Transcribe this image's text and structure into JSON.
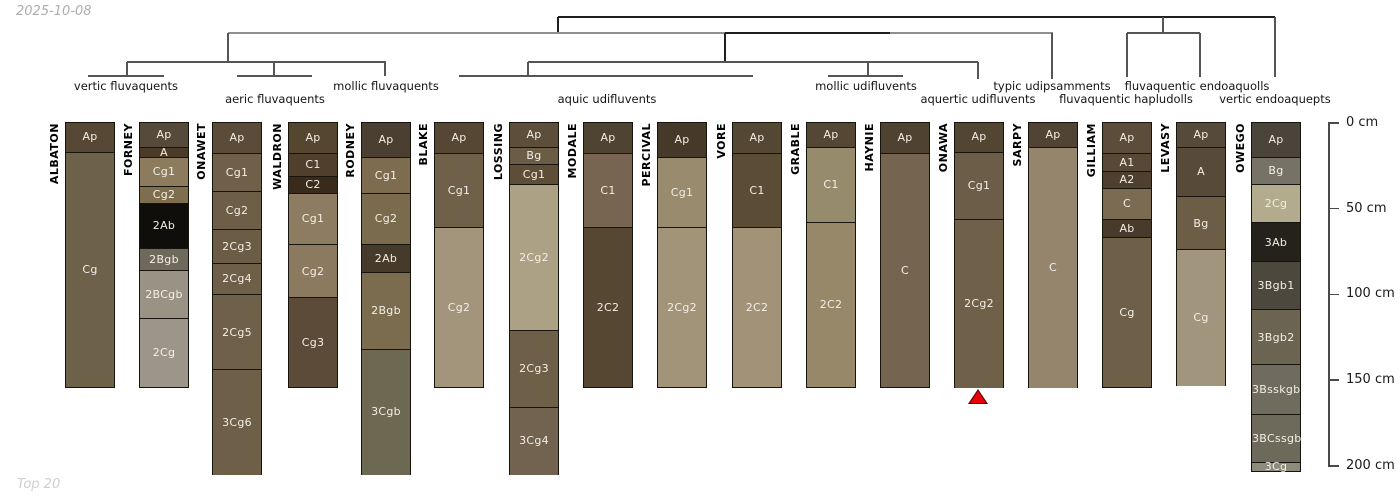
{
  "header": {
    "date": "2025-10-08"
  },
  "footer": {
    "note": "Top 20"
  },
  "depth_axis": {
    "unit": "cm",
    "ticks": [
      {
        "value": 0,
        "label": "0 cm"
      },
      {
        "value": 50,
        "label": "50 cm"
      },
      {
        "value": 100,
        "label": "100 cm"
      },
      {
        "value": 150,
        "label": "150 cm"
      },
      {
        "value": 200,
        "label": "200 cm"
      }
    ]
  },
  "chart_data": {
    "type": "dendrogram_soil_profiles",
    "description": "Hierarchical clustering dendrogram over 17 soil series profiles grouped by taxonomic subgroup, with horizon columns drawn to a 0-200 cm depth scale",
    "groups": [
      {
        "label": "vertic fluvaquents",
        "x": 126,
        "row": 1
      },
      {
        "label": "aeric fluvaquents",
        "x": 275,
        "row": 2
      },
      {
        "label": "mollic fluvaquents",
        "x": 386,
        "row": 1
      },
      {
        "label": "aquic udifluvents",
        "x": 607,
        "row": 2
      },
      {
        "label": "mollic udifluvents",
        "x": 866,
        "row": 1
      },
      {
        "label": "aquertic udifluvents",
        "x": 978,
        "row": 2
      },
      {
        "label": "typic udipsamments",
        "x": 1052,
        "row": 1
      },
      {
        "label": "fluvaquentic hapludolls",
        "x": 1126,
        "row": 2
      },
      {
        "label": "fluvaquentic endoaquolls",
        "x": 1197,
        "row": 1
      },
      {
        "label": "vertic endoaquepts",
        "x": 1275,
        "row": 2
      }
    ],
    "dendrogram_segments": [
      [
        558,
        17,
        1275,
        17,
        "d"
      ],
      [
        558,
        17,
        558,
        33,
        "d"
      ],
      [
        1275,
        17,
        1275,
        77,
        "m"
      ],
      [
        1163,
        17,
        1163,
        33,
        "m"
      ],
      [
        228,
        33,
        1053,
        33,
        "l"
      ],
      [
        725,
        33,
        890,
        33,
        "d"
      ],
      [
        228,
        33,
        228,
        62,
        "m"
      ],
      [
        725,
        33,
        725,
        62,
        "d"
      ],
      [
        1052,
        33,
        1052,
        79,
        "m"
      ],
      [
        1127,
        33,
        1200,
        33,
        "m"
      ],
      [
        1127,
        33,
        1127,
        77,
        "m"
      ],
      [
        1200,
        33,
        1200,
        77,
        "m"
      ],
      [
        127,
        62,
        386,
        62,
        "m"
      ],
      [
        127,
        62,
        127,
        76,
        "m"
      ],
      [
        274,
        62,
        274,
        76,
        "m"
      ],
      [
        385,
        62,
        385,
        76,
        "m"
      ],
      [
        528,
        62,
        978,
        62,
        "m"
      ],
      [
        528,
        62,
        528,
        76,
        "m"
      ],
      [
        868,
        62,
        868,
        76,
        "m"
      ],
      [
        978,
        62,
        978,
        79,
        "m"
      ],
      [
        88,
        76,
        164,
        76,
        "m"
      ],
      [
        237,
        76,
        312,
        76,
        "m"
      ],
      [
        459,
        76,
        753,
        76,
        "m"
      ],
      [
        828,
        76,
        903,
        76,
        "m"
      ]
    ],
    "profiles": [
      {
        "name": "ALBATON",
        "x_center": 89,
        "horizons": [
          {
            "label": "Ap",
            "top_cm": 0,
            "bottom_cm": 17,
            "color": "#574836"
          },
          {
            "label": "Cg",
            "top_cm": 17,
            "bottom_cm": 154,
            "color": "#6e6149"
          }
        ]
      },
      {
        "name": "FORNEY",
        "x_center": 163,
        "horizons": [
          {
            "label": "Ap",
            "top_cm": 0,
            "bottom_cm": 14,
            "color": "#564a3a"
          },
          {
            "label": "A",
            "top_cm": 14,
            "bottom_cm": 20,
            "color": "#4a3c28"
          },
          {
            "label": "Cg1",
            "top_cm": 20,
            "bottom_cm": 37,
            "color": "#8d7b5e"
          },
          {
            "label": "Cg2",
            "top_cm": 37,
            "bottom_cm": 47,
            "color": "#7f6e4e"
          },
          {
            "label": "2Ab",
            "top_cm": 47,
            "bottom_cm": 73,
            "color": "#100e0a"
          },
          {
            "label": "2Bgb",
            "top_cm": 73,
            "bottom_cm": 86,
            "color": "#6f695b"
          },
          {
            "label": "2BCgb",
            "top_cm": 86,
            "bottom_cm": 114,
            "color": "#999386"
          },
          {
            "label": "2Cg",
            "top_cm": 114,
            "bottom_cm": 154,
            "color": "#9c968a"
          }
        ]
      },
      {
        "name": "ONAWET",
        "x_center": 236,
        "horizons": [
          {
            "label": "Ap",
            "top_cm": 0,
            "bottom_cm": 18,
            "color": "#5b4c39"
          },
          {
            "label": "Cg1",
            "top_cm": 18,
            "bottom_cm": 40,
            "color": "#716049"
          },
          {
            "label": "Cg2",
            "top_cm": 40,
            "bottom_cm": 62,
            "color": "#6d5e47"
          },
          {
            "label": "2Cg3",
            "top_cm": 62,
            "bottom_cm": 82,
            "color": "#6a5c45"
          },
          {
            "label": "2Cg4",
            "top_cm": 82,
            "bottom_cm": 100,
            "color": "#6d5f48"
          },
          {
            "label": "2Cg5",
            "top_cm": 100,
            "bottom_cm": 144,
            "color": "#6f6049"
          },
          {
            "label": "3Cg6",
            "top_cm": 144,
            "bottom_cm": 205,
            "color": "#6d5f48"
          }
        ]
      },
      {
        "name": "WALDRON",
        "x_center": 312,
        "horizons": [
          {
            "label": "Ap",
            "top_cm": 0,
            "bottom_cm": 18,
            "color": "#55462f"
          },
          {
            "label": "C1",
            "top_cm": 18,
            "bottom_cm": 31,
            "color": "#503f2c"
          },
          {
            "label": "C2",
            "top_cm": 31,
            "bottom_cm": 41,
            "color": "#392a1b"
          },
          {
            "label": "Cg1",
            "top_cm": 41,
            "bottom_cm": 71,
            "color": "#8d7b62"
          },
          {
            "label": "Cg2",
            "top_cm": 71,
            "bottom_cm": 102,
            "color": "#8b7960"
          },
          {
            "label": "Cg3",
            "top_cm": 102,
            "bottom_cm": 154,
            "color": "#5c4b38"
          }
        ]
      },
      {
        "name": "RODNEY",
        "x_center": 385,
        "horizons": [
          {
            "label": "Ap",
            "top_cm": 0,
            "bottom_cm": 20,
            "color": "#4a3f31"
          },
          {
            "label": "Cg1",
            "top_cm": 20,
            "bottom_cm": 41,
            "color": "#7d6c50"
          },
          {
            "label": "Cg2",
            "top_cm": 41,
            "bottom_cm": 71,
            "color": "#7a6a4e"
          },
          {
            "label": "2Ab",
            "top_cm": 71,
            "bottom_cm": 87,
            "color": "#463b2a"
          },
          {
            "label": "2Bgb",
            "top_cm": 87,
            "bottom_cm": 132,
            "color": "#7b6b4f"
          },
          {
            "label": "3Cgb",
            "top_cm": 132,
            "bottom_cm": 205,
            "color": "#6d6852"
          }
        ]
      },
      {
        "name": "BLAKE",
        "x_center": 458,
        "horizons": [
          {
            "label": "Ap",
            "top_cm": 0,
            "bottom_cm": 18,
            "color": "#564734"
          },
          {
            "label": "Cg1",
            "top_cm": 18,
            "bottom_cm": 61,
            "color": "#6f604a"
          },
          {
            "label": "Cg2",
            "top_cm": 61,
            "bottom_cm": 154,
            "color": "#a3947c"
          }
        ]
      },
      {
        "name": "LOSSING",
        "x_center": 533,
        "horizons": [
          {
            "label": "Ap",
            "top_cm": 0,
            "bottom_cm": 14,
            "color": "#5c4e3b"
          },
          {
            "label": "Bg",
            "top_cm": 14,
            "bottom_cm": 24,
            "color": "#6b5c46"
          },
          {
            "label": "Cg1",
            "top_cm": 24,
            "bottom_cm": 36,
            "color": "#5e4e38"
          },
          {
            "label": "2Cg2",
            "top_cm": 36,
            "bottom_cm": 121,
            "color": "#ada185"
          },
          {
            "label": "2Cg3",
            "top_cm": 121,
            "bottom_cm": 166,
            "color": "#6e6048"
          },
          {
            "label": "3Cg4",
            "top_cm": 166,
            "bottom_cm": 205,
            "color": "#716350"
          }
        ]
      },
      {
        "name": "MODALE",
        "x_center": 607,
        "horizons": [
          {
            "label": "Ap",
            "top_cm": 0,
            "bottom_cm": 18,
            "color": "#4f4331"
          },
          {
            "label": "C1",
            "top_cm": 18,
            "bottom_cm": 61,
            "color": "#776551"
          },
          {
            "label": "2C2",
            "top_cm": 61,
            "bottom_cm": 154,
            "color": "#564732"
          }
        ]
      },
      {
        "name": "PERCIVAL",
        "x_center": 681,
        "horizons": [
          {
            "label": "Ap",
            "top_cm": 0,
            "bottom_cm": 20,
            "color": "#46392a"
          },
          {
            "label": "Cg1",
            "top_cm": 20,
            "bottom_cm": 61,
            "color": "#988b6e"
          },
          {
            "label": "2Cg2",
            "top_cm": 61,
            "bottom_cm": 154,
            "color": "#a29479"
          }
        ]
      },
      {
        "name": "VORE",
        "x_center": 756,
        "horizons": [
          {
            "label": "Ap",
            "top_cm": 0,
            "bottom_cm": 18,
            "color": "#544733"
          },
          {
            "label": "C1",
            "top_cm": 18,
            "bottom_cm": 61,
            "color": "#5b4c36"
          },
          {
            "label": "2C2",
            "top_cm": 61,
            "bottom_cm": 154,
            "color": "#a19278"
          }
        ]
      },
      {
        "name": "GRABLE",
        "x_center": 830,
        "horizons": [
          {
            "label": "Ap",
            "top_cm": 0,
            "bottom_cm": 14,
            "color": "#544733"
          },
          {
            "label": "C1",
            "top_cm": 14,
            "bottom_cm": 58,
            "color": "#978b6e"
          },
          {
            "label": "2C2",
            "top_cm": 58,
            "bottom_cm": 154,
            "color": "#968868"
          }
        ]
      },
      {
        "name": "HAYNIE",
        "x_center": 904,
        "horizons": [
          {
            "label": "Ap",
            "top_cm": 0,
            "bottom_cm": 18,
            "color": "#4f4231"
          },
          {
            "label": "C",
            "top_cm": 18,
            "bottom_cm": 154,
            "color": "#75644f"
          }
        ]
      },
      {
        "name": "ONAWA",
        "x_center": 978,
        "horizons": [
          {
            "label": "Ap",
            "top_cm": 0,
            "bottom_cm": 17,
            "color": "#524532"
          },
          {
            "label": "Cg1",
            "top_cm": 17,
            "bottom_cm": 56,
            "color": "#6b5d47"
          },
          {
            "label": "2Cg2",
            "top_cm": 56,
            "bottom_cm": 154,
            "color": "#6e6049"
          }
        ]
      },
      {
        "name": "SARPY",
        "x_center": 1052,
        "horizons": [
          {
            "label": "Ap",
            "top_cm": 0,
            "bottom_cm": 14,
            "color": "#514434"
          },
          {
            "label": "C",
            "top_cm": 14,
            "bottom_cm": 154,
            "color": "#94856c"
          }
        ]
      },
      {
        "name": "GILLIAM",
        "x_center": 1126,
        "horizons": [
          {
            "label": "Ap",
            "top_cm": 0,
            "bottom_cm": 18,
            "color": "#5b4d3a"
          },
          {
            "label": "A1",
            "top_cm": 18,
            "bottom_cm": 28,
            "color": "#574935"
          },
          {
            "label": "A2",
            "top_cm": 28,
            "bottom_cm": 38,
            "color": "#4d402f"
          },
          {
            "label": "C",
            "top_cm": 38,
            "bottom_cm": 56,
            "color": "#7c6b53"
          },
          {
            "label": "Ab",
            "top_cm": 56,
            "bottom_cm": 67,
            "color": "#483b2b"
          },
          {
            "label": "Cg",
            "top_cm": 67,
            "bottom_cm": 154,
            "color": "#6e5f49"
          }
        ]
      },
      {
        "name": "LEVASY",
        "x_center": 1200,
        "horizons": [
          {
            "label": "Ap",
            "top_cm": 0,
            "bottom_cm": 14,
            "color": "#564a3b"
          },
          {
            "label": "A",
            "top_cm": 14,
            "bottom_cm": 43,
            "color": "#574a38"
          },
          {
            "label": "Bg",
            "top_cm": 43,
            "bottom_cm": 74,
            "color": "#6c5d46"
          },
          {
            "label": "Cg",
            "top_cm": 74,
            "bottom_cm": 153,
            "color": "#a2957d"
          }
        ]
      },
      {
        "name": "OWEGO",
        "x_center": 1275,
        "horizons": [
          {
            "label": "Ap",
            "top_cm": 0,
            "bottom_cm": 20,
            "color": "#4a443a"
          },
          {
            "label": "Bg",
            "top_cm": 20,
            "bottom_cm": 36,
            "color": "#767266"
          },
          {
            "label": "2Cg",
            "top_cm": 36,
            "bottom_cm": 58,
            "color": "#b3ab8e"
          },
          {
            "label": "3Ab",
            "top_cm": 58,
            "bottom_cm": 81,
            "color": "#25221c"
          },
          {
            "label": "3Bgb1",
            "top_cm": 81,
            "bottom_cm": 109,
            "color": "#4c483d"
          },
          {
            "label": "3Bgb2",
            "top_cm": 109,
            "bottom_cm": 141,
            "color": "#6a6450"
          },
          {
            "label": "3Bsskgb",
            "top_cm": 141,
            "bottom_cm": 170,
            "color": "#6f6b5f"
          },
          {
            "label": "3BCssgb",
            "top_cm": 170,
            "bottom_cm": 198,
            "color": "#6d695b"
          },
          {
            "label": "3Cg",
            "top_cm": 198,
            "bottom_cm": 203,
            "color": "#8e8b7c"
          }
        ]
      }
    ],
    "marker": {
      "profile": "ONAWA",
      "x": 978,
      "shape": "triangle-up",
      "color": "#e8000b",
      "outline": "#5a0000"
    }
  }
}
